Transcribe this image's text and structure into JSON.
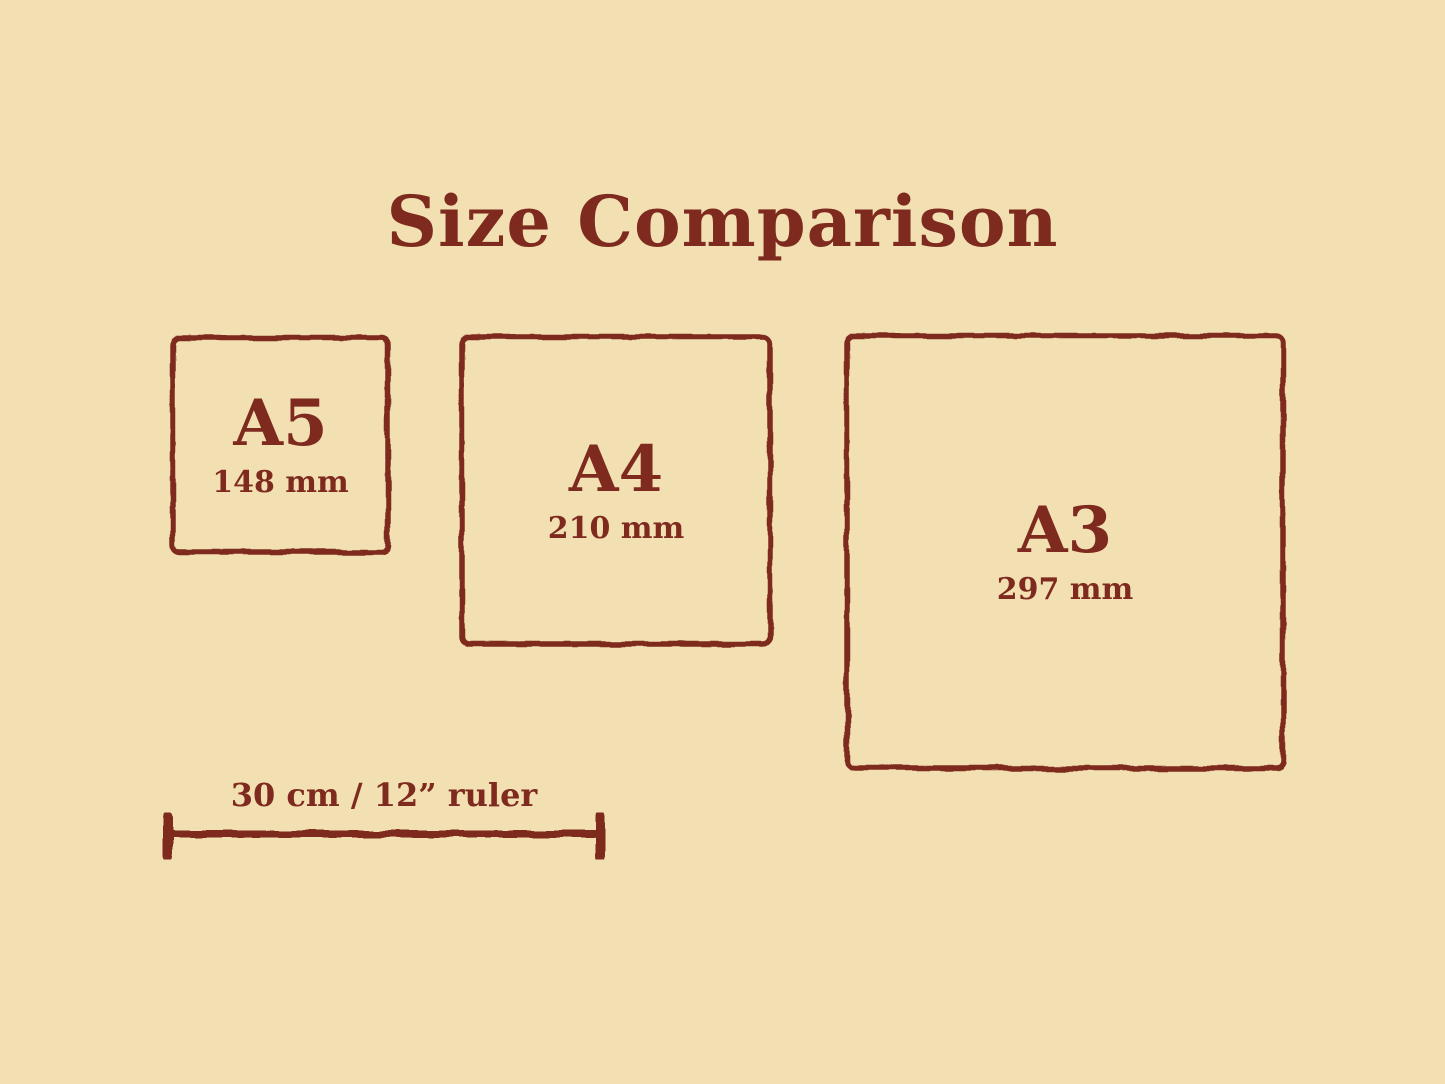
{
  "title": "Size Comparison",
  "colors": {
    "background": "#f2dfb2",
    "ink": "#7e2a1e"
  },
  "sizes": [
    {
      "label": "A5",
      "dimension": "148 mm"
    },
    {
      "label": "A4",
      "dimension": "210 mm"
    },
    {
      "label": "A3",
      "dimension": "297 mm"
    }
  ],
  "ruler": {
    "label": "30 cm / 12” ruler"
  }
}
